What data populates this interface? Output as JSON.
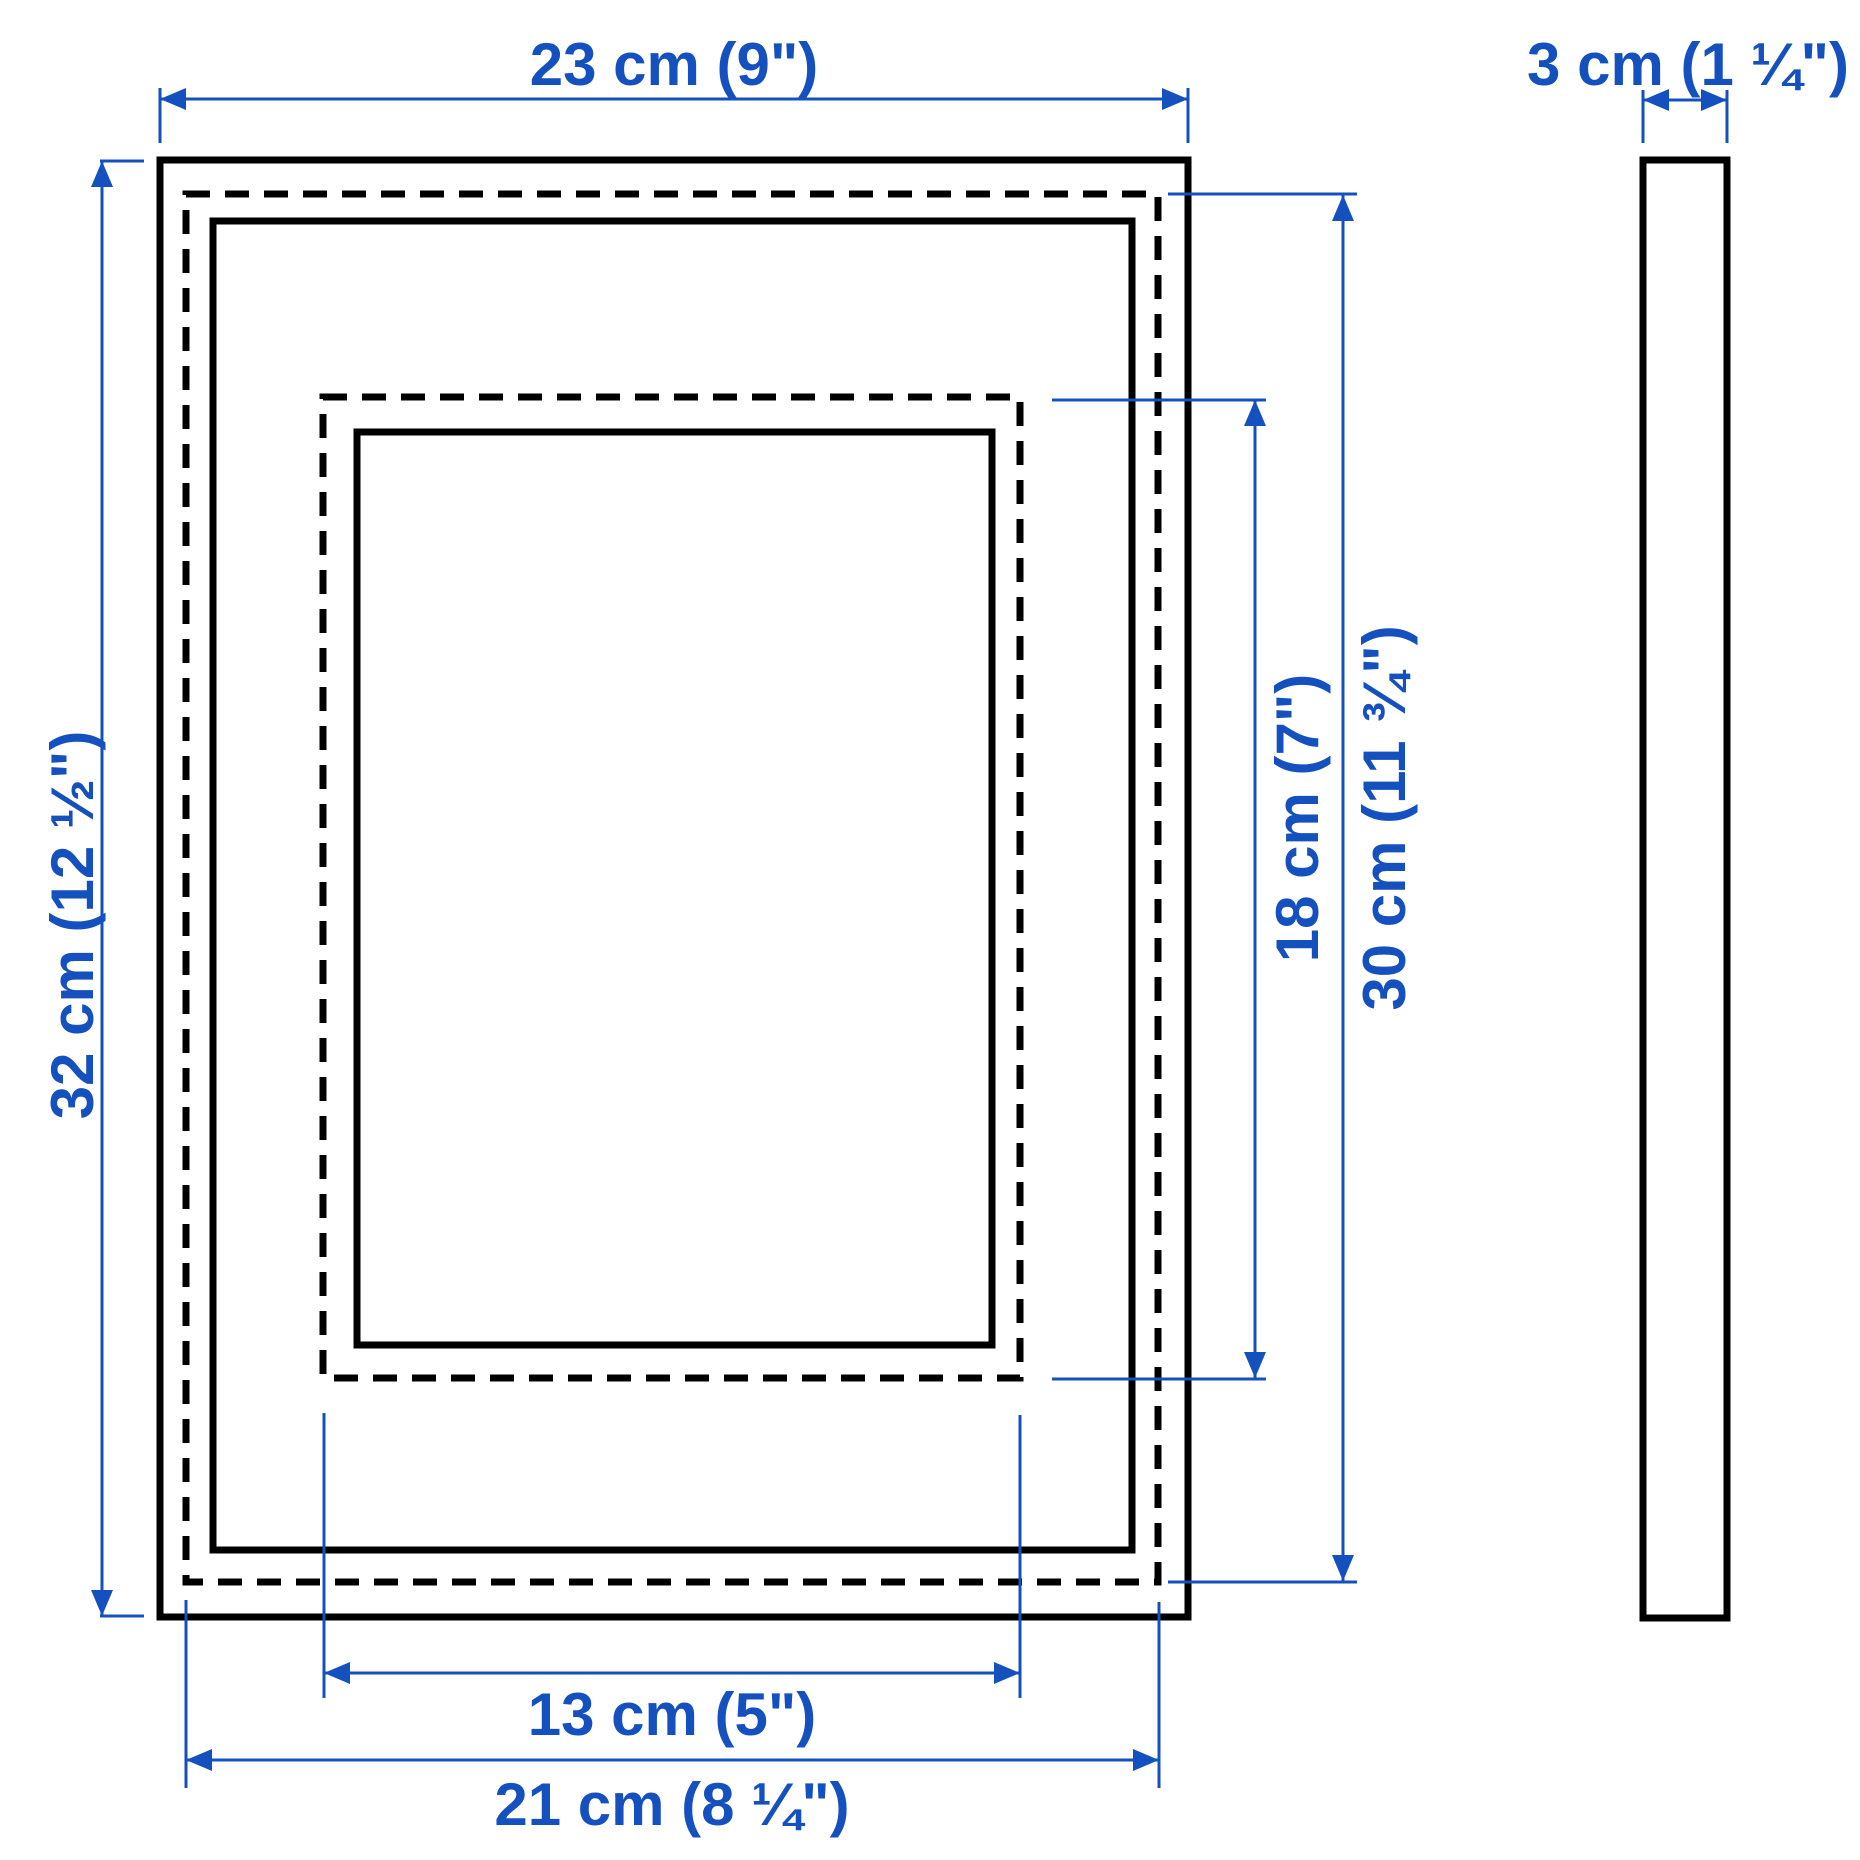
{
  "diagram": {
    "type": "product-dimension-diagram",
    "product": "picture frame",
    "views": {
      "front": "front view with frame edge, back/picture boundary (dashed), inner edge, mat opening (dashed) and visible opening",
      "side": "side profile"
    }
  },
  "colors": {
    "dimension_blue": "#1551be",
    "line_black": "#000000",
    "background": "#ffffff"
  },
  "dimensions": {
    "frame_width": {
      "value": "23 cm (9\")"
    },
    "frame_depth": {
      "value": "3 cm (1 ¼\")"
    },
    "frame_height": {
      "value": "32 cm (12 ½\")"
    },
    "picture_height": {
      "value": "30 cm (11 ¾\")"
    },
    "opening_height": {
      "value": "18 cm (7\")"
    },
    "opening_width": {
      "value": "13 cm (5\")"
    },
    "picture_width": {
      "value": "21 cm (8 ¼\")"
    }
  }
}
